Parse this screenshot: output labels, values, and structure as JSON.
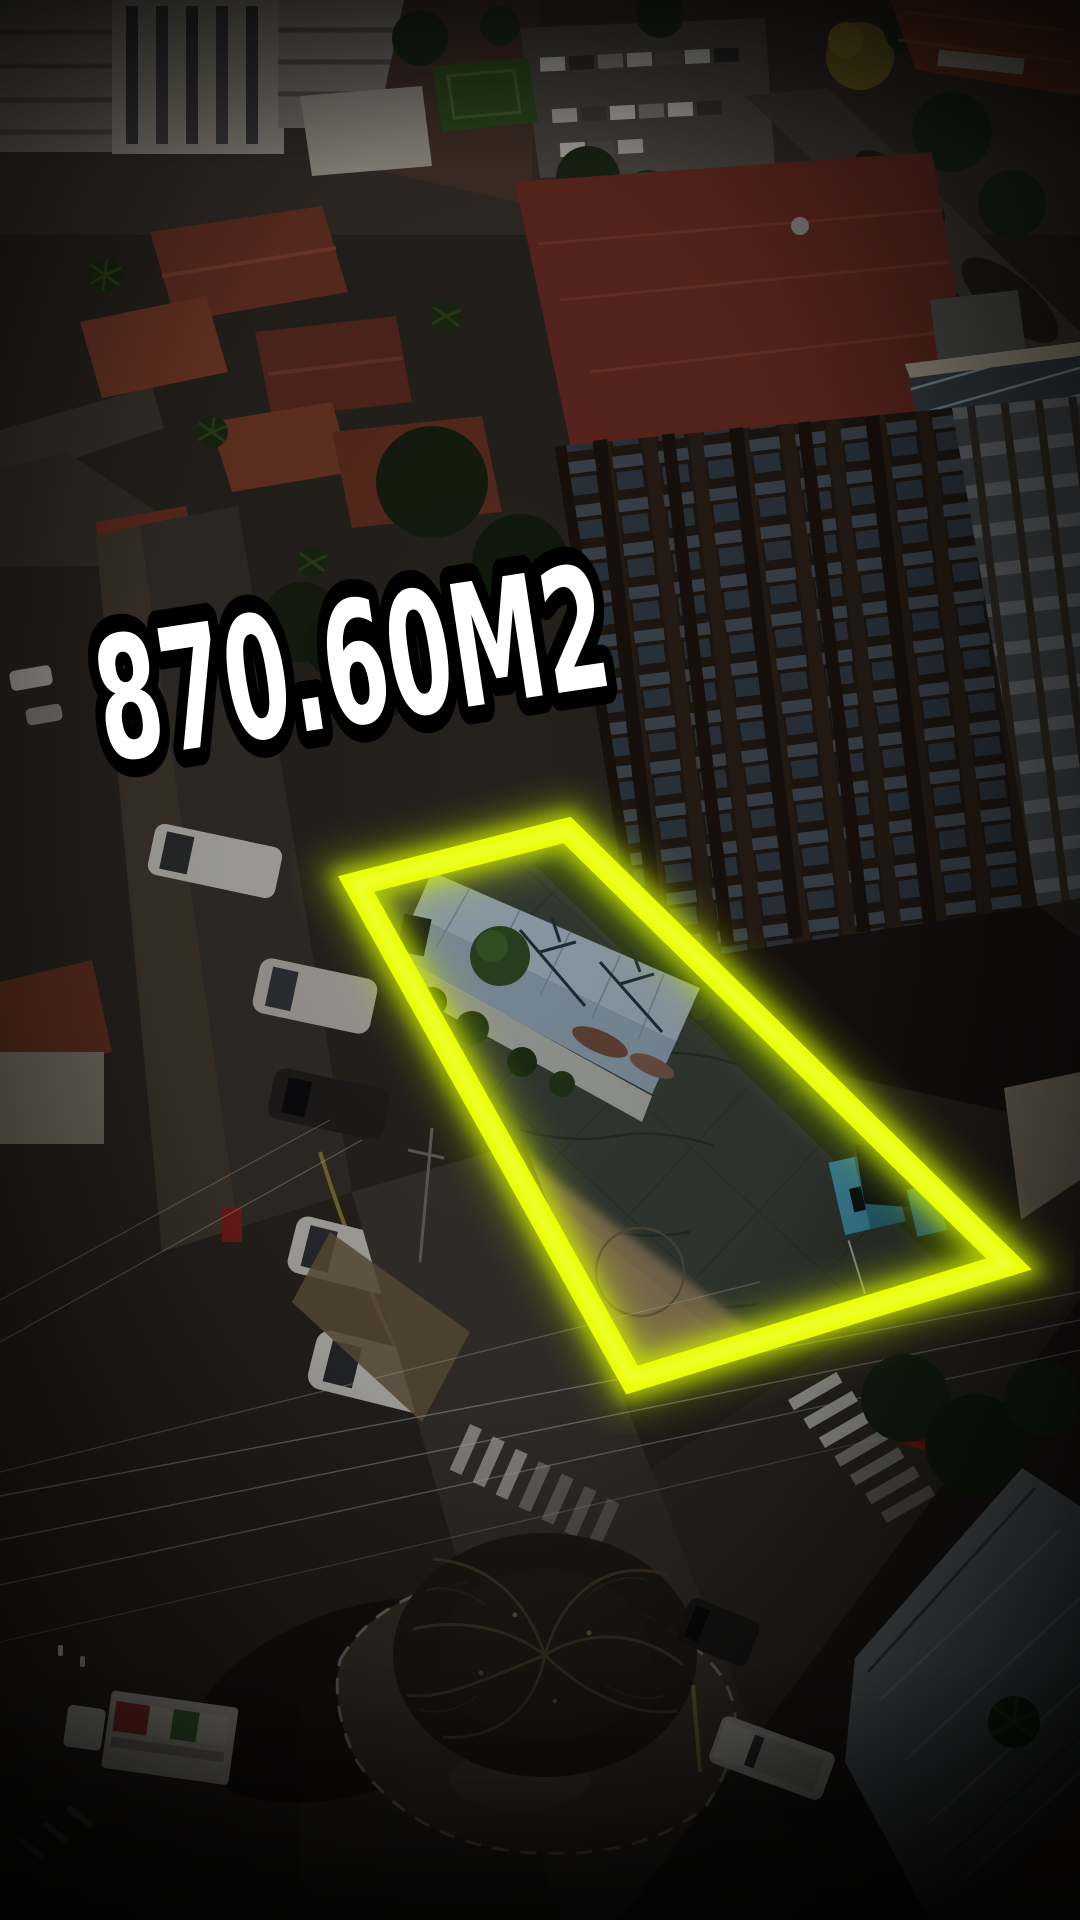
{
  "overlay": {
    "area_label": "870.60M2",
    "text_color": "#ffffff",
    "text_outline_color": "#000000"
  },
  "highlight": {
    "outline_color": "#e9ff00",
    "glow_color": "#d6f400",
    "inner_color": "#f9ffa8",
    "polygon_points": "356,884 567,830 1009,1264 632,1380"
  },
  "photo": {
    "vignette_color": "#000000"
  }
}
